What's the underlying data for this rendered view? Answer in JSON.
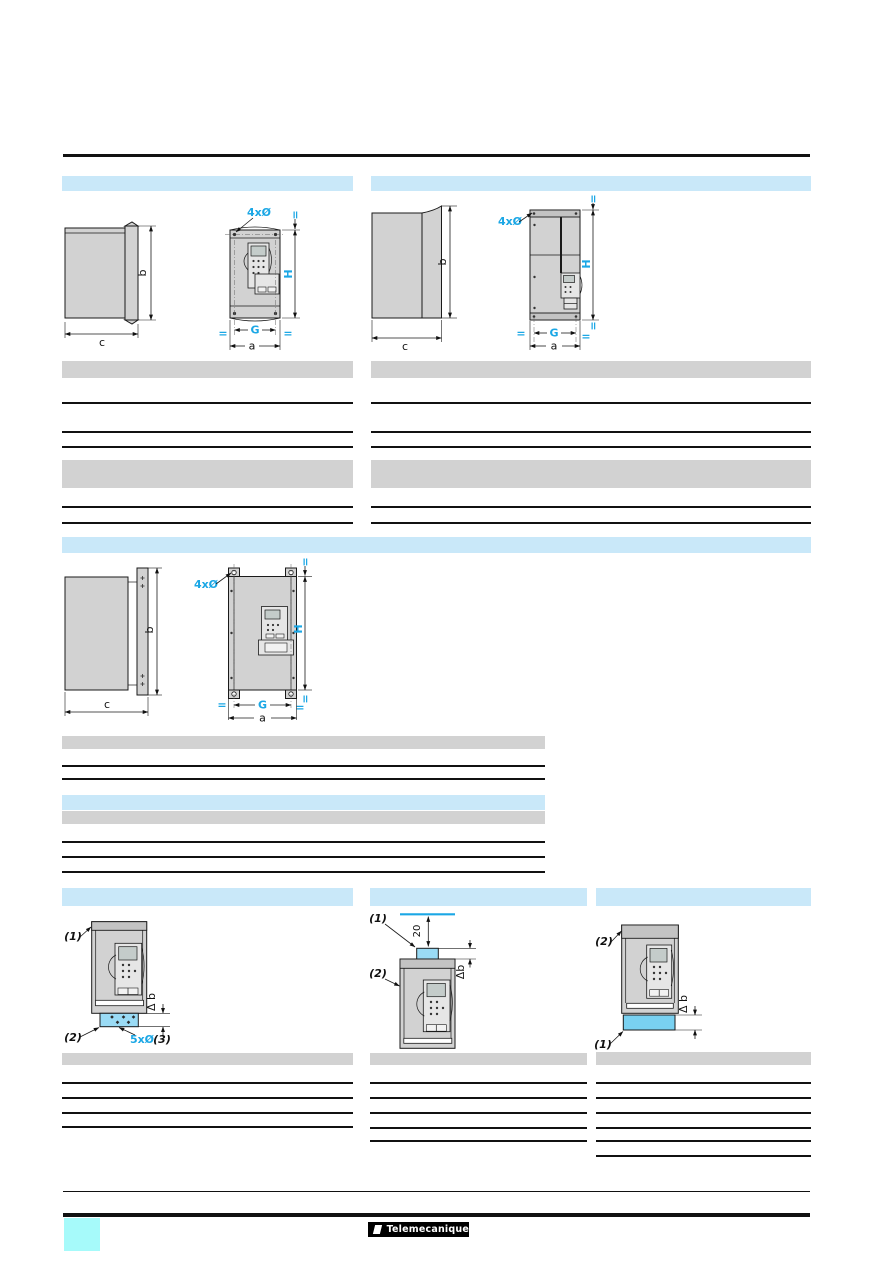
{
  "document": {
    "kind": "product-catalog-dimensions-page",
    "brand": "Telemecanique"
  },
  "dims": {
    "holes4": "4xØ",
    "holes5": "5xØ",
    "a": "a",
    "b": "b",
    "c": "c",
    "G": "G",
    "H": "H",
    "eq": "=",
    "delta_b": "Δ b",
    "delta_b_tight": "Δb",
    "gap20": "20",
    "note1": "(1)",
    "note2": "(2)",
    "note3": "(3)"
  },
  "colors": {
    "section_header_blue": "#C9E8F9",
    "table_header_gray": "#D2D2D2",
    "accent_blue": "#1BA7E5",
    "highlight_fill_blue": "#9ADBF5",
    "highlight_fill_cyan": "#79D1F1",
    "device_gray": "#D2D2D2",
    "corner_tab_cyan": "#A6FAFA"
  }
}
